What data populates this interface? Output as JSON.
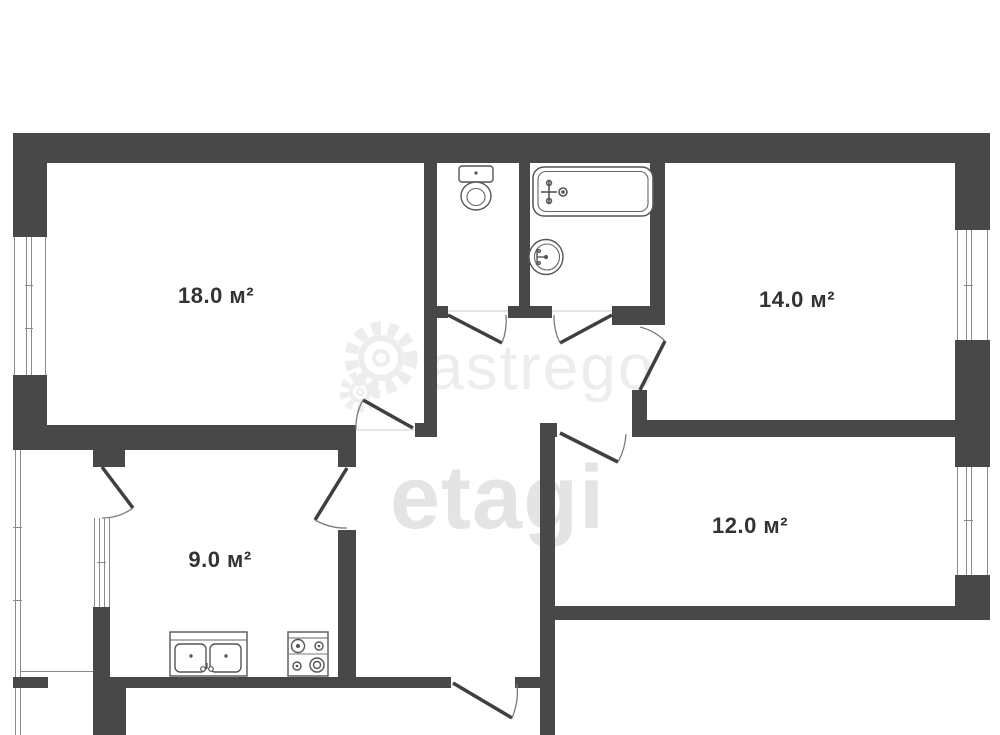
{
  "plan": {
    "type": "apartment-floor-plan",
    "rooms": [
      {
        "id": "room-18",
        "area_label": "18.0 м²"
      },
      {
        "id": "room-14",
        "area_label": "14.0 м²"
      },
      {
        "id": "kitchen",
        "area_label": "9.0 м²"
      },
      {
        "id": "room-12",
        "area_label": "12.0 м²"
      }
    ],
    "fixtures": [
      "toilet",
      "bathtub",
      "wash-basin",
      "kitchen-sink",
      "stove-4-burner"
    ],
    "windows": [
      "room-18-left",
      "kitchen-left",
      "room-14-right",
      "room-12-right",
      "balcony-glazing"
    ],
    "doors": [
      "room-18",
      "wc",
      "bathroom",
      "room-14",
      "room-12",
      "kitchen",
      "balcony",
      "entry"
    ],
    "watermark": {
      "logo_icon": "gear-icon",
      "logo_text": "astrego",
      "brand_text": "etagi"
    },
    "colors": {
      "wall": "#484848",
      "fixture_line": "#555555",
      "label_text": "#333333",
      "watermark": "#ededed",
      "background": "#ffffff"
    }
  }
}
